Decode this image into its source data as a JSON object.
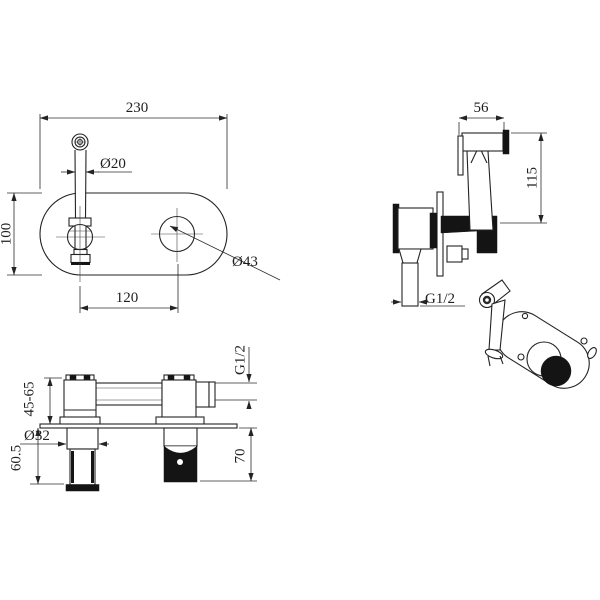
{
  "page": {
    "background": "#ffffff",
    "line_color": "#1f1f1f"
  },
  "views": {
    "front": {
      "label": "front view of oval trim plate with spout and handle",
      "dims": {
        "plate_width": "230",
        "spout_diameter": "Ø20",
        "plate_height": "100",
        "handle_hole_diameter": "Ø43",
        "hole_spacing": "120"
      }
    },
    "sprayer_side": {
      "label": "hand sprayer and concealed valve side view",
      "dims": {
        "head_width": "56",
        "overall_height": "115",
        "outlet_thread": "G1/2"
      }
    },
    "perspective": {
      "label": "assembled perspective view"
    },
    "installed_section": {
      "label": "installed side section view",
      "dims": {
        "inlet_thread": "G1/2",
        "wall_depth_range": "45-65",
        "trim_diameter": "Ø32",
        "spout_projection": "60.5",
        "handle_projection": "70"
      }
    }
  }
}
